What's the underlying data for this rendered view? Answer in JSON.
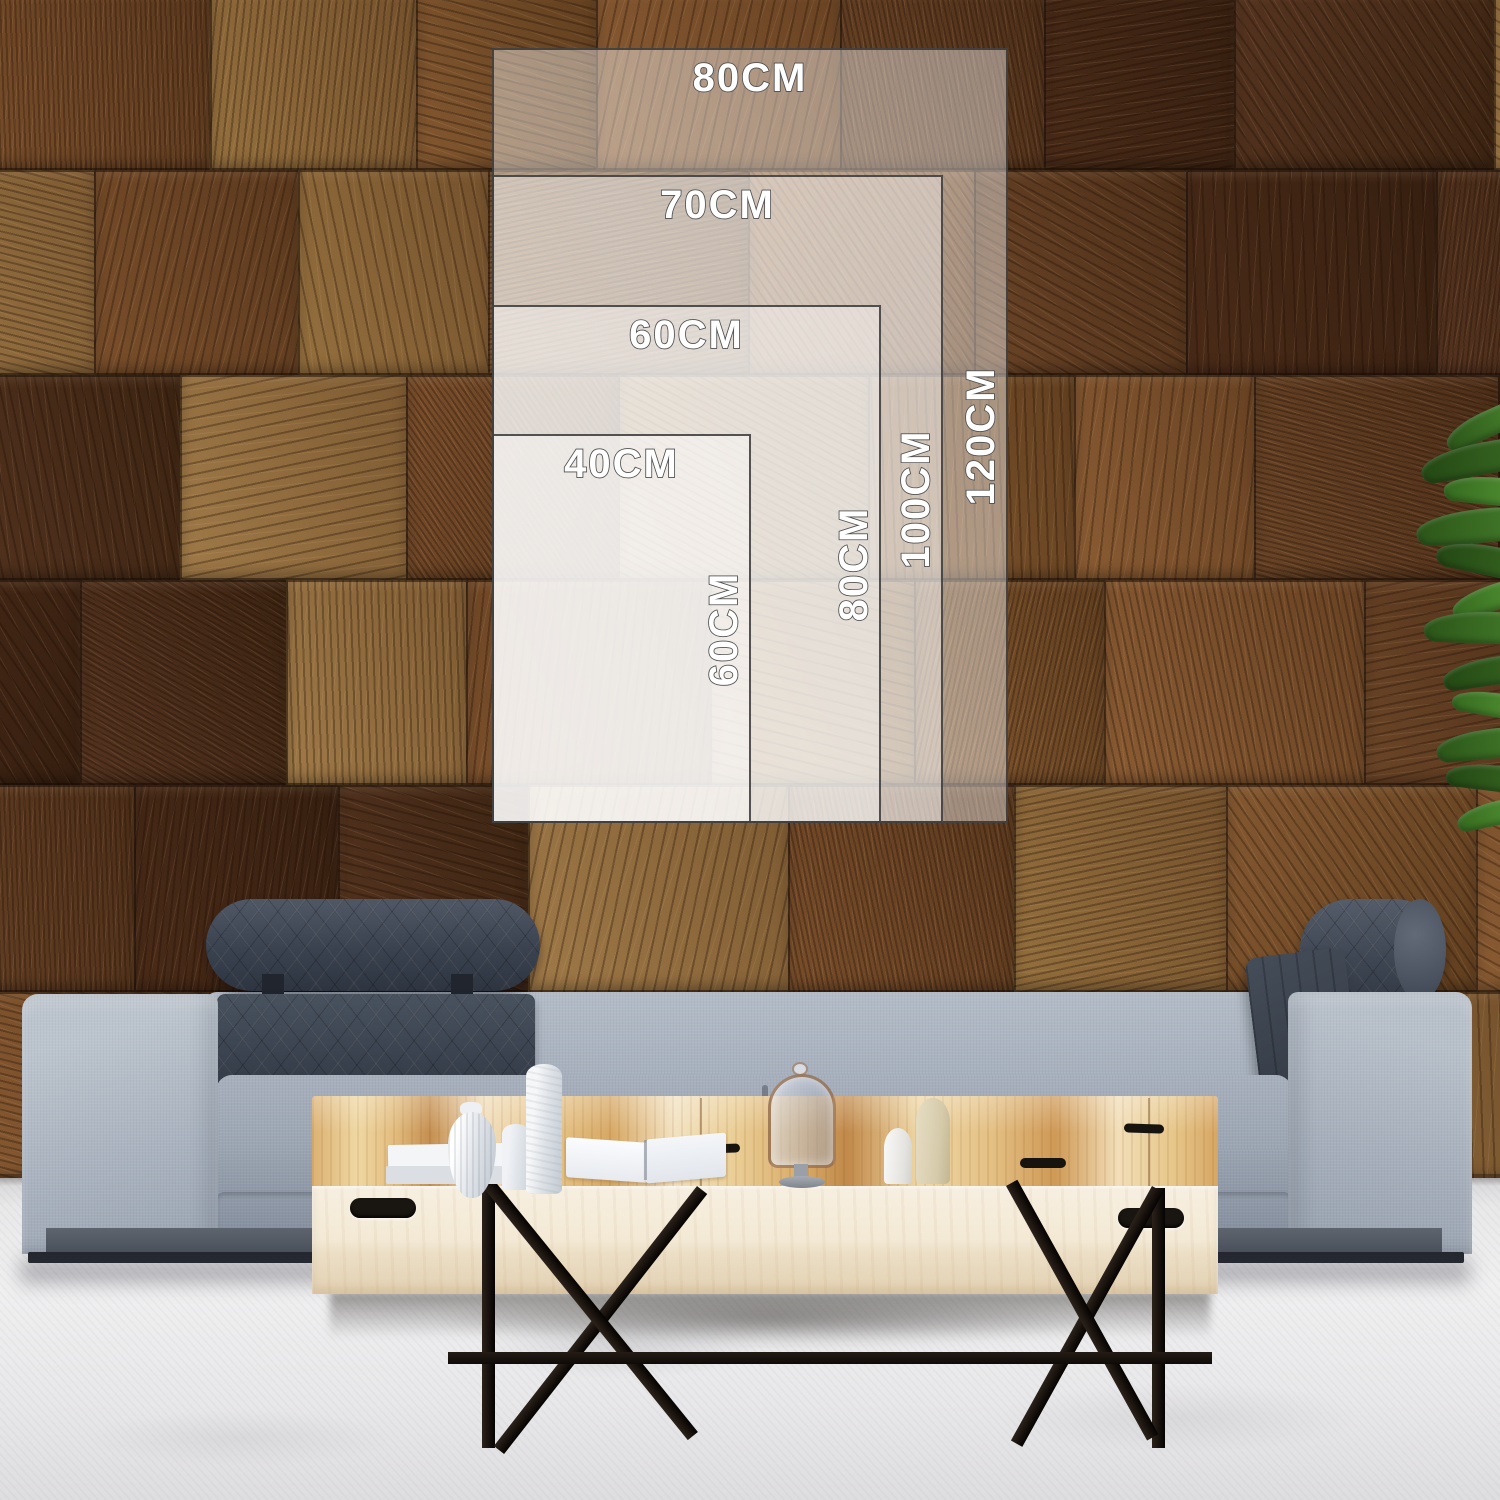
{
  "size_chart": {
    "sizes": [
      {
        "id": "80x120",
        "width_label": "80CM",
        "height_label": "120CM"
      },
      {
        "id": "70x100",
        "width_label": "70CM",
        "height_label": "100CM"
      },
      {
        "id": "60x80",
        "width_label": "60CM",
        "height_label": "80CM"
      },
      {
        "id": "40x60",
        "width_label": "40CM",
        "height_label": "60CM"
      }
    ],
    "label_color": "#ffffff",
    "label_outline_color": "#4e4e4e",
    "overlay_fill": "rgba(255,255,255,0.42)",
    "overlay_border_color": "#303030"
  }
}
